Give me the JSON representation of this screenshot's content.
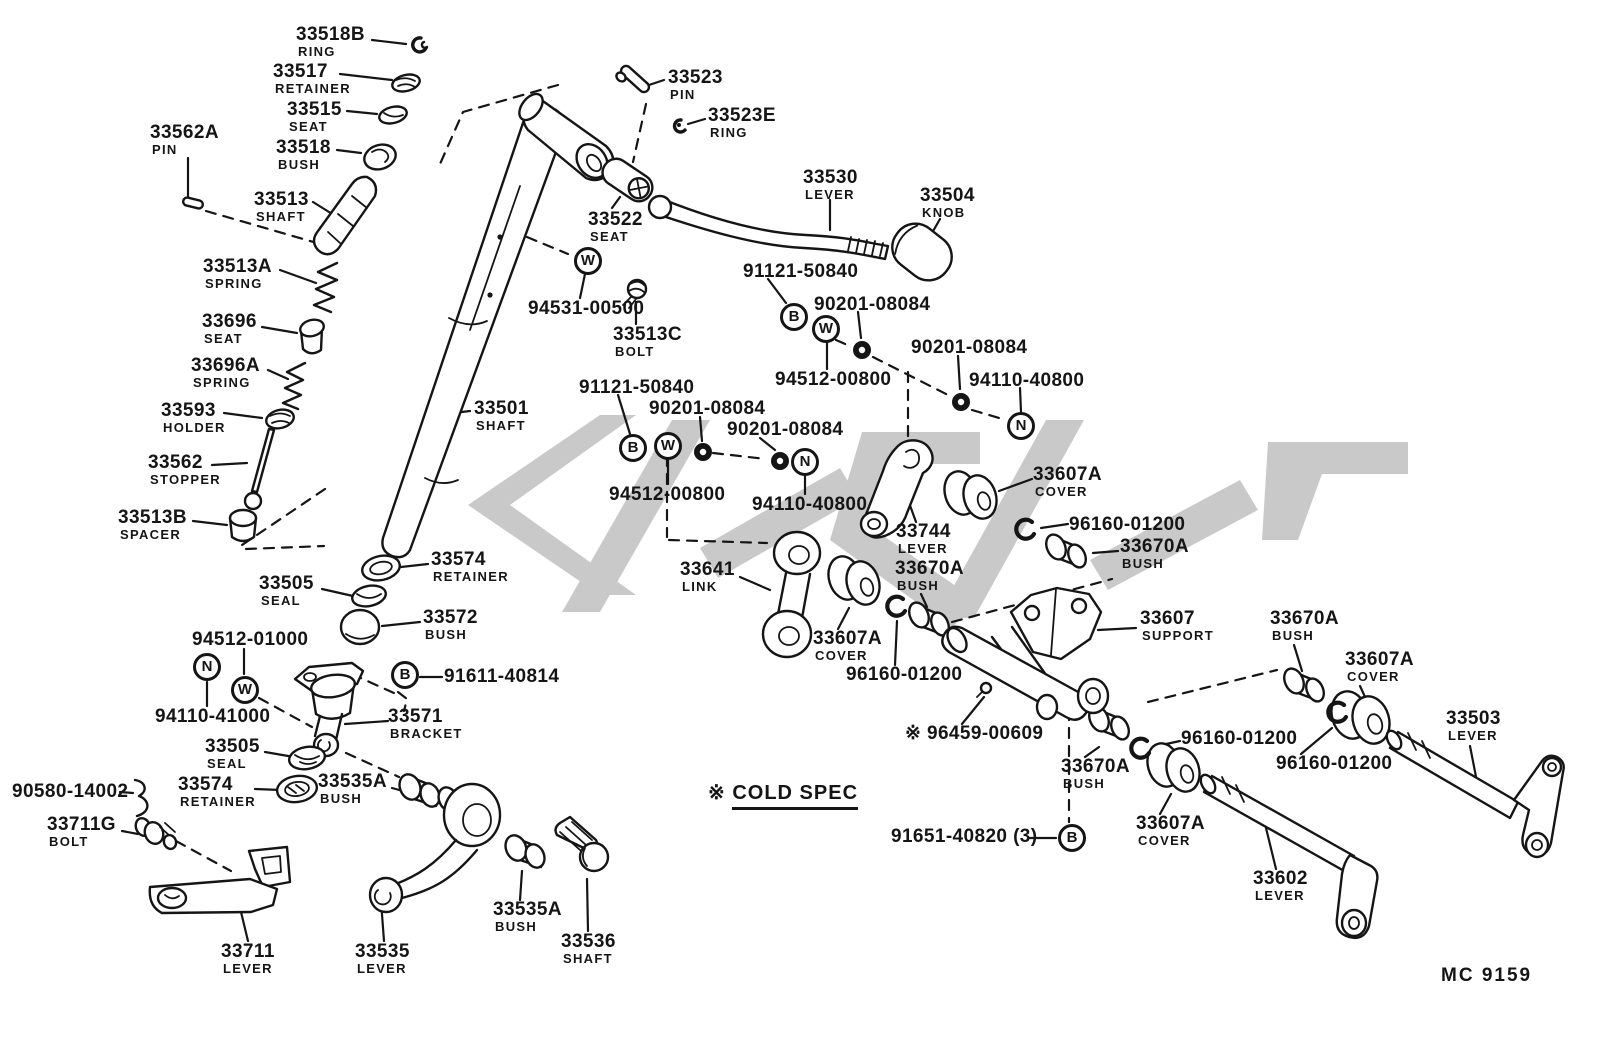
{
  "diagram": {
    "drawing_code": "MC 9159",
    "note_prefix": "※ ",
    "note_text": "COLD SPEC",
    "colors": {
      "ink": "#151515",
      "watermark": "#c9c9c9",
      "background": "#ffffff"
    },
    "labels": [
      {
        "num": "33518B",
        "name": "RING"
      },
      {
        "num": "33517",
        "name": "RETAINER"
      },
      {
        "num": "33515",
        "name": "SEAT"
      },
      {
        "num": "33518",
        "name": "BUSH"
      },
      {
        "num": "33562A",
        "name": "PIN"
      },
      {
        "num": "33513",
        "name": "SHAFT"
      },
      {
        "num": "33513A",
        "name": "SPRING"
      },
      {
        "num": "33696",
        "name": "SEAT"
      },
      {
        "num": "33696A",
        "name": "SPRING"
      },
      {
        "num": "33593",
        "name": "HOLDER"
      },
      {
        "num": "33562",
        "name": "STOPPER"
      },
      {
        "num": "33513B",
        "name": "SPACER"
      },
      {
        "num": "33501",
        "name": "SHAFT"
      },
      {
        "num": "33574",
        "name": "RETAINER"
      },
      {
        "num": "33505",
        "name": "SEAL"
      },
      {
        "num": "33572",
        "name": "BUSH"
      },
      {
        "num": "33523",
        "name": "PIN"
      },
      {
        "num": "33523E",
        "name": "RING"
      },
      {
        "num": "33530",
        "name": "LEVER"
      },
      {
        "num": "33504",
        "name": "KNOB"
      },
      {
        "num": "33522",
        "name": "SEAT"
      },
      {
        "num": "94531-00500",
        "name": ""
      },
      {
        "num": "33513C",
        "name": "BOLT"
      },
      {
        "num": "91121-50840",
        "name": ""
      },
      {
        "num": "90201-08084",
        "name": ""
      },
      {
        "num": "94512-00800",
        "name": ""
      },
      {
        "num": "90201-08084",
        "name": ""
      },
      {
        "num": "94110-40800",
        "name": ""
      },
      {
        "num": "91121-50840",
        "name": ""
      },
      {
        "num": "90201-08084",
        "name": ""
      },
      {
        "num": "90201-08084",
        "name": ""
      },
      {
        "num": "94512-00800",
        "name": ""
      },
      {
        "num": "94110-40800",
        "name": ""
      },
      {
        "num": "33607A",
        "name": "COVER"
      },
      {
        "num": "96160-01200",
        "name": ""
      },
      {
        "num": "33670A",
        "name": "BUSH"
      },
      {
        "num": "33744",
        "name": "LEVER"
      },
      {
        "num": "33670A",
        "name": "BUSH"
      },
      {
        "num": "33641",
        "name": "LINK"
      },
      {
        "num": "33607A",
        "name": "COVER"
      },
      {
        "num": "96160-01200",
        "name": ""
      },
      {
        "num": "33607",
        "name": "SUPPORT"
      },
      {
        "num": "33670A",
        "name": "BUSH"
      },
      {
        "num": "33607A",
        "name": "COVER"
      },
      {
        "num": "33503",
        "name": "LEVER"
      },
      {
        "num": "96160-01200",
        "name": ""
      },
      {
        "num": "96160-01200",
        "name": ""
      },
      {
        "num": "33670A",
        "name": "BUSH"
      },
      {
        "num": "33607A",
        "name": "COVER"
      },
      {
        "num": "※ 96459-00609",
        "name": ""
      },
      {
        "num": "91651-40820 (3)",
        "name": ""
      },
      {
        "num": "33602",
        "name": "LEVER"
      },
      {
        "num": "94512-01000",
        "name": ""
      },
      {
        "num": "94110-41000",
        "name": ""
      },
      {
        "num": "91611-40814",
        "name": ""
      },
      {
        "num": "33571",
        "name": "BRACKET"
      },
      {
        "num": "33505",
        "name": "SEAL"
      },
      {
        "num": "33574",
        "name": "RETAINER"
      },
      {
        "num": "33535A",
        "name": "BUSH"
      },
      {
        "num": "90580-14002",
        "name": ""
      },
      {
        "num": "33711G",
        "name": "BOLT"
      },
      {
        "num": "33711",
        "name": "LEVER"
      },
      {
        "num": "33535",
        "name": "LEVER"
      },
      {
        "num": "33535A",
        "name": "BUSH"
      },
      {
        "num": "33536",
        "name": "SHAFT"
      }
    ],
    "symbols": [
      {
        "letter": "W"
      },
      {
        "letter": "B"
      },
      {
        "letter": "W"
      },
      {
        "letter": "N"
      },
      {
        "letter": "B"
      },
      {
        "letter": "W"
      },
      {
        "letter": "N"
      },
      {
        "letter": "N"
      },
      {
        "letter": "W"
      },
      {
        "letter": "B"
      },
      {
        "letter": "B"
      }
    ]
  }
}
